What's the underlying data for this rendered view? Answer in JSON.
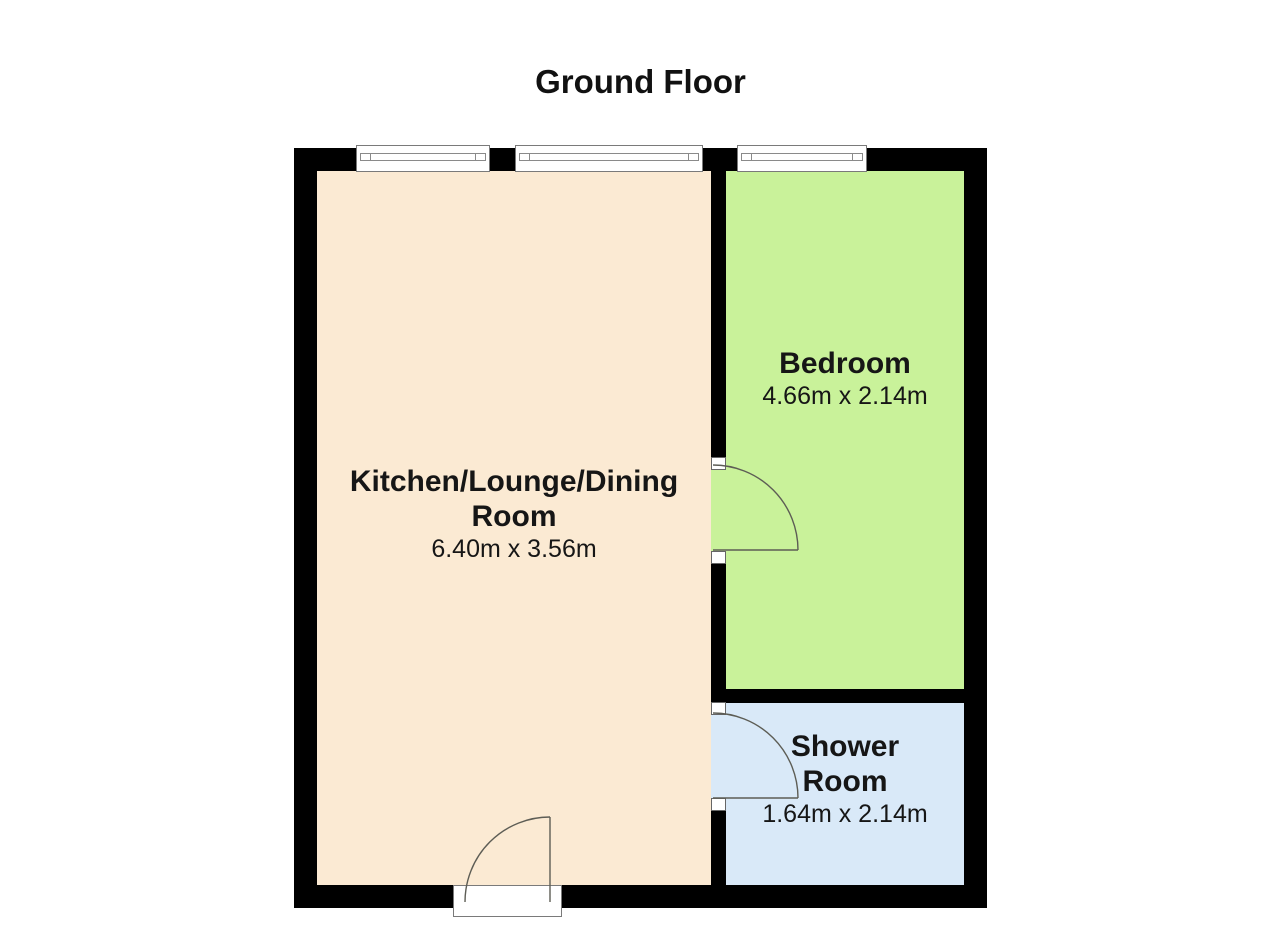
{
  "title": "Ground Floor",
  "rooms": {
    "kitchen": {
      "name_line1": "Kitchen/Lounge/Dining",
      "name_line2": "Room",
      "dims": "6.40m x 3.56m"
    },
    "bedroom": {
      "name": "Bedroom",
      "dims": "4.66m x 2.14m"
    },
    "shower": {
      "name_line1": "Shower",
      "name_line2": "Room",
      "dims": "1.64m x 2.14m"
    }
  },
  "colors": {
    "wall": "#000000",
    "kitchen_fill": "#fbead3",
    "bedroom_fill": "#c9f29a",
    "shower_fill": "#d9e9f8",
    "window_fill": "#ffffff",
    "line": "#5d5d55"
  }
}
